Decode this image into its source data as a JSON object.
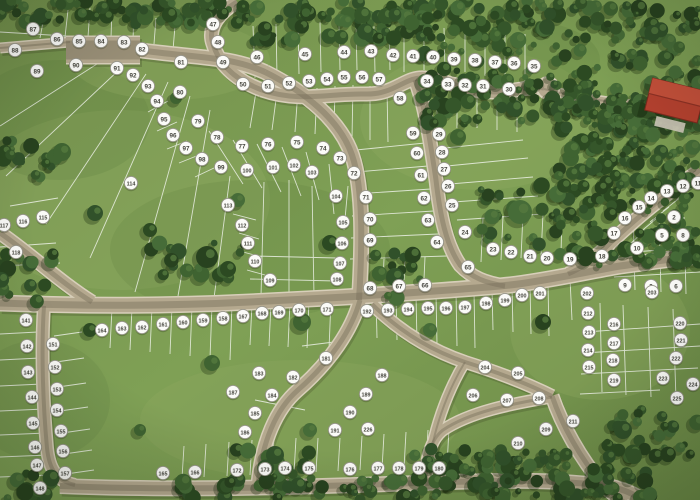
{
  "map": {
    "title": "residential-lot-masterplan-aerial",
    "colors": {
      "grass": "#7b9852",
      "grass_light": "#93ad63",
      "grass_dark": "#5e7f41",
      "forest": "#33522a",
      "road": "#b5a98f",
      "road_edge": "#d8cfba",
      "lot_line": "#ffffff",
      "marker_bg": "#fbfbf8",
      "marker_border": "#97958a",
      "marker_text": "#44443c",
      "building_roof": "#b5412f"
    },
    "markers": [
      {
        "n": "2",
        "x": 674,
        "y": 217
      },
      {
        "n": "5",
        "x": 662,
        "y": 235
      },
      {
        "n": "8",
        "x": 683,
        "y": 235
      },
      {
        "n": "10",
        "x": 637,
        "y": 248
      },
      {
        "n": "9",
        "x": 625,
        "y": 285
      },
      {
        "n": "3",
        "x": 651,
        "y": 286
      },
      {
        "n": "6",
        "x": 676,
        "y": 286
      },
      {
        "n": "11",
        "x": 698,
        "y": 183
      },
      {
        "n": "12",
        "x": 683,
        "y": 186
      },
      {
        "n": "13",
        "x": 667,
        "y": 191
      },
      {
        "n": "14",
        "x": 651,
        "y": 198
      },
      {
        "n": "15",
        "x": 639,
        "y": 207
      },
      {
        "n": "16",
        "x": 625,
        "y": 218
      },
      {
        "n": "17",
        "x": 614,
        "y": 233
      },
      {
        "n": "18",
        "x": 602,
        "y": 256
      },
      {
        "n": "19",
        "x": 570,
        "y": 259
      },
      {
        "n": "20",
        "x": 547,
        "y": 258
      },
      {
        "n": "21",
        "x": 530,
        "y": 256
      },
      {
        "n": "22",
        "x": 511,
        "y": 252
      },
      {
        "n": "23",
        "x": 493,
        "y": 249
      },
      {
        "n": "24",
        "x": 465,
        "y": 232
      },
      {
        "n": "25",
        "x": 452,
        "y": 205
      },
      {
        "n": "26",
        "x": 448,
        "y": 186
      },
      {
        "n": "27",
        "x": 444,
        "y": 169
      },
      {
        "n": "28",
        "x": 442,
        "y": 152
      },
      {
        "n": "29",
        "x": 439,
        "y": 134
      },
      {
        "n": "30",
        "x": 509,
        "y": 89
      },
      {
        "n": "31",
        "x": 483,
        "y": 86
      },
      {
        "n": "32",
        "x": 465,
        "y": 85
      },
      {
        "n": "33",
        "x": 448,
        "y": 84
      },
      {
        "n": "34",
        "x": 427,
        "y": 81
      },
      {
        "n": "35",
        "x": 534,
        "y": 66
      },
      {
        "n": "36",
        "x": 514,
        "y": 63
      },
      {
        "n": "37",
        "x": 495,
        "y": 62
      },
      {
        "n": "38",
        "x": 475,
        "y": 60
      },
      {
        "n": "39",
        "x": 454,
        "y": 59
      },
      {
        "n": "40",
        "x": 433,
        "y": 57
      },
      {
        "n": "41",
        "x": 413,
        "y": 56
      },
      {
        "n": "42",
        "x": 393,
        "y": 55
      },
      {
        "n": "43",
        "x": 371,
        "y": 51
      },
      {
        "n": "44",
        "x": 344,
        "y": 52
      },
      {
        "n": "45",
        "x": 305,
        "y": 54
      },
      {
        "n": "46",
        "x": 257,
        "y": 57
      },
      {
        "n": "47",
        "x": 213,
        "y": 24
      },
      {
        "n": "48",
        "x": 218,
        "y": 42
      },
      {
        "n": "49",
        "x": 223,
        "y": 62
      },
      {
        "n": "50",
        "x": 243,
        "y": 84
      },
      {
        "n": "51",
        "x": 268,
        "y": 86
      },
      {
        "n": "52",
        "x": 289,
        "y": 83
      },
      {
        "n": "53",
        "x": 309,
        "y": 81
      },
      {
        "n": "54",
        "x": 327,
        "y": 79
      },
      {
        "n": "55",
        "x": 344,
        "y": 77
      },
      {
        "n": "56",
        "x": 362,
        "y": 77
      },
      {
        "n": "57",
        "x": 379,
        "y": 79
      },
      {
        "n": "58",
        "x": 400,
        "y": 98
      },
      {
        "n": "59",
        "x": 413,
        "y": 133
      },
      {
        "n": "60",
        "x": 417,
        "y": 153
      },
      {
        "n": "61",
        "x": 421,
        "y": 175
      },
      {
        "n": "62",
        "x": 424,
        "y": 198
      },
      {
        "n": "63",
        "x": 428,
        "y": 220
      },
      {
        "n": "64",
        "x": 437,
        "y": 242
      },
      {
        "n": "65",
        "x": 468,
        "y": 267
      },
      {
        "n": "66",
        "x": 425,
        "y": 285
      },
      {
        "n": "67",
        "x": 399,
        "y": 286
      },
      {
        "n": "68",
        "x": 370,
        "y": 288
      },
      {
        "n": "69",
        "x": 370,
        "y": 240
      },
      {
        "n": "70",
        "x": 370,
        "y": 219
      },
      {
        "n": "71",
        "x": 366,
        "y": 197
      },
      {
        "n": "72",
        "x": 354,
        "y": 173
      },
      {
        "n": "73",
        "x": 340,
        "y": 158
      },
      {
        "n": "74",
        "x": 323,
        "y": 148
      },
      {
        "n": "75",
        "x": 297,
        "y": 142
      },
      {
        "n": "76",
        "x": 268,
        "y": 144
      },
      {
        "n": "77",
        "x": 242,
        "y": 146
      },
      {
        "n": "78",
        "x": 217,
        "y": 137
      },
      {
        "n": "79",
        "x": 198,
        "y": 121
      },
      {
        "n": "80",
        "x": 180,
        "y": 92
      },
      {
        "n": "81",
        "x": 181,
        "y": 62
      },
      {
        "n": "82",
        "x": 142,
        "y": 49
      },
      {
        "n": "83",
        "x": 124,
        "y": 42
      },
      {
        "n": "84",
        "x": 101,
        "y": 41
      },
      {
        "n": "85",
        "x": 79,
        "y": 41
      },
      {
        "n": "86",
        "x": 57,
        "y": 39
      },
      {
        "n": "87",
        "x": 33,
        "y": 29
      },
      {
        "n": "88",
        "x": 15,
        "y": 50
      },
      {
        "n": "89",
        "x": 37,
        "y": 71
      },
      {
        "n": "90",
        "x": 76,
        "y": 65
      },
      {
        "n": "91",
        "x": 117,
        "y": 68
      },
      {
        "n": "92",
        "x": 133,
        "y": 75
      },
      {
        "n": "93",
        "x": 148,
        "y": 86
      },
      {
        "n": "94",
        "x": 157,
        "y": 101
      },
      {
        "n": "95",
        "x": 164,
        "y": 119
      },
      {
        "n": "96",
        "x": 173,
        "y": 135
      },
      {
        "n": "97",
        "x": 186,
        "y": 148
      },
      {
        "n": "98",
        "x": 202,
        "y": 159
      },
      {
        "n": "99",
        "x": 221,
        "y": 167
      },
      {
        "n": "100",
        "x": 247,
        "y": 170
      },
      {
        "n": "101",
        "x": 273,
        "y": 167
      },
      {
        "n": "102",
        "x": 294,
        "y": 165
      },
      {
        "n": "103",
        "x": 312,
        "y": 172
      },
      {
        "n": "104",
        "x": 336,
        "y": 196
      },
      {
        "n": "105",
        "x": 343,
        "y": 222
      },
      {
        "n": "106",
        "x": 342,
        "y": 243
      },
      {
        "n": "107",
        "x": 340,
        "y": 263
      },
      {
        "n": "108",
        "x": 337,
        "y": 279
      },
      {
        "n": "109",
        "x": 270,
        "y": 280
      },
      {
        "n": "110",
        "x": 255,
        "y": 261
      },
      {
        "n": "111",
        "x": 248,
        "y": 243
      },
      {
        "n": "112",
        "x": 242,
        "y": 225
      },
      {
        "n": "113",
        "x": 228,
        "y": 205
      },
      {
        "n": "114",
        "x": 131,
        "y": 183
      },
      {
        "n": "115",
        "x": 43,
        "y": 217
      },
      {
        "n": "116",
        "x": 23,
        "y": 221
      },
      {
        "n": "117",
        "x": 4,
        "y": 225
      },
      {
        "n": "118",
        "x": 16,
        "y": 252
      },
      {
        "n": "141",
        "x": 26,
        "y": 320
      },
      {
        "n": "142",
        "x": 27,
        "y": 346
      },
      {
        "n": "143",
        "x": 28,
        "y": 372
      },
      {
        "n": "144",
        "x": 32,
        "y": 397
      },
      {
        "n": "145",
        "x": 33,
        "y": 423
      },
      {
        "n": "146",
        "x": 35,
        "y": 447
      },
      {
        "n": "147",
        "x": 37,
        "y": 465
      },
      {
        "n": "148",
        "x": 40,
        "y": 488
      },
      {
        "n": "151",
        "x": 53,
        "y": 344
      },
      {
        "n": "152",
        "x": 55,
        "y": 367
      },
      {
        "n": "153",
        "x": 57,
        "y": 389
      },
      {
        "n": "154",
        "x": 57,
        "y": 410
      },
      {
        "n": "155",
        "x": 61,
        "y": 431
      },
      {
        "n": "156",
        "x": 63,
        "y": 451
      },
      {
        "n": "157",
        "x": 65,
        "y": 473
      },
      {
        "n": "158",
        "x": 223,
        "y": 318
      },
      {
        "n": "159",
        "x": 203,
        "y": 320
      },
      {
        "n": "160",
        "x": 183,
        "y": 322
      },
      {
        "n": "161",
        "x": 163,
        "y": 324
      },
      {
        "n": "162",
        "x": 142,
        "y": 327
      },
      {
        "n": "163",
        "x": 122,
        "y": 328
      },
      {
        "n": "164",
        "x": 102,
        "y": 330
      },
      {
        "n": "165",
        "x": 163,
        "y": 473
      },
      {
        "n": "166",
        "x": 195,
        "y": 472
      },
      {
        "n": "167",
        "x": 243,
        "y": 316
      },
      {
        "n": "168",
        "x": 262,
        "y": 313
      },
      {
        "n": "169",
        "x": 279,
        "y": 312
      },
      {
        "n": "170",
        "x": 299,
        "y": 310
      },
      {
        "n": "171",
        "x": 327,
        "y": 309
      },
      {
        "n": "172",
        "x": 237,
        "y": 470
      },
      {
        "n": "173",
        "x": 265,
        "y": 469
      },
      {
        "n": "174",
        "x": 285,
        "y": 468
      },
      {
        "n": "175",
        "x": 309,
        "y": 468
      },
      {
        "n": "176",
        "x": 350,
        "y": 469
      },
      {
        "n": "177",
        "x": 378,
        "y": 468
      },
      {
        "n": "178",
        "x": 399,
        "y": 468
      },
      {
        "n": "179",
        "x": 419,
        "y": 468
      },
      {
        "n": "180",
        "x": 439,
        "y": 468
      },
      {
        "n": "181",
        "x": 326,
        "y": 358
      },
      {
        "n": "182",
        "x": 293,
        "y": 377
      },
      {
        "n": "183",
        "x": 259,
        "y": 373
      },
      {
        "n": "184",
        "x": 272,
        "y": 395
      },
      {
        "n": "185",
        "x": 255,
        "y": 413
      },
      {
        "n": "186",
        "x": 245,
        "y": 432
      },
      {
        "n": "187",
        "x": 233,
        "y": 392
      },
      {
        "n": "188",
        "x": 382,
        "y": 375
      },
      {
        "n": "189",
        "x": 366,
        "y": 394
      },
      {
        "n": "190",
        "x": 350,
        "y": 412
      },
      {
        "n": "191",
        "x": 335,
        "y": 430
      },
      {
        "n": "192",
        "x": 367,
        "y": 311
      },
      {
        "n": "193",
        "x": 388,
        "y": 310
      },
      {
        "n": "194",
        "x": 408,
        "y": 309
      },
      {
        "n": "195",
        "x": 428,
        "y": 308
      },
      {
        "n": "196",
        "x": 446,
        "y": 308
      },
      {
        "n": "197",
        "x": 465,
        "y": 307
      },
      {
        "n": "198",
        "x": 486,
        "y": 303
      },
      {
        "n": "199",
        "x": 505,
        "y": 300
      },
      {
        "n": "200",
        "x": 522,
        "y": 295
      },
      {
        "n": "201",
        "x": 540,
        "y": 293
      },
      {
        "n": "202",
        "x": 587,
        "y": 293
      },
      {
        "n": "203",
        "x": 652,
        "y": 292
      },
      {
        "n": "204",
        "x": 485,
        "y": 367
      },
      {
        "n": "205",
        "x": 518,
        "y": 373
      },
      {
        "n": "206",
        "x": 473,
        "y": 395
      },
      {
        "n": "207",
        "x": 507,
        "y": 400
      },
      {
        "n": "208",
        "x": 539,
        "y": 398
      },
      {
        "n": "209",
        "x": 546,
        "y": 429
      },
      {
        "n": "210",
        "x": 518,
        "y": 443
      },
      {
        "n": "211",
        "x": 573,
        "y": 421
      },
      {
        "n": "212",
        "x": 588,
        "y": 313
      },
      {
        "n": "213",
        "x": 589,
        "y": 332
      },
      {
        "n": "214",
        "x": 588,
        "y": 350
      },
      {
        "n": "215",
        "x": 589,
        "y": 367
      },
      {
        "n": "216",
        "x": 614,
        "y": 324
      },
      {
        "n": "217",
        "x": 614,
        "y": 343
      },
      {
        "n": "218",
        "x": 613,
        "y": 360
      },
      {
        "n": "219",
        "x": 614,
        "y": 380
      },
      {
        "n": "220",
        "x": 680,
        "y": 323
      },
      {
        "n": "221",
        "x": 681,
        "y": 340
      },
      {
        "n": "222",
        "x": 676,
        "y": 358
      },
      {
        "n": "223",
        "x": 663,
        "y": 378
      },
      {
        "n": "224",
        "x": 693,
        "y": 384
      },
      {
        "n": "225",
        "x": 677,
        "y": 398
      },
      {
        "n": "226",
        "x": 368,
        "y": 429
      }
    ]
  }
}
